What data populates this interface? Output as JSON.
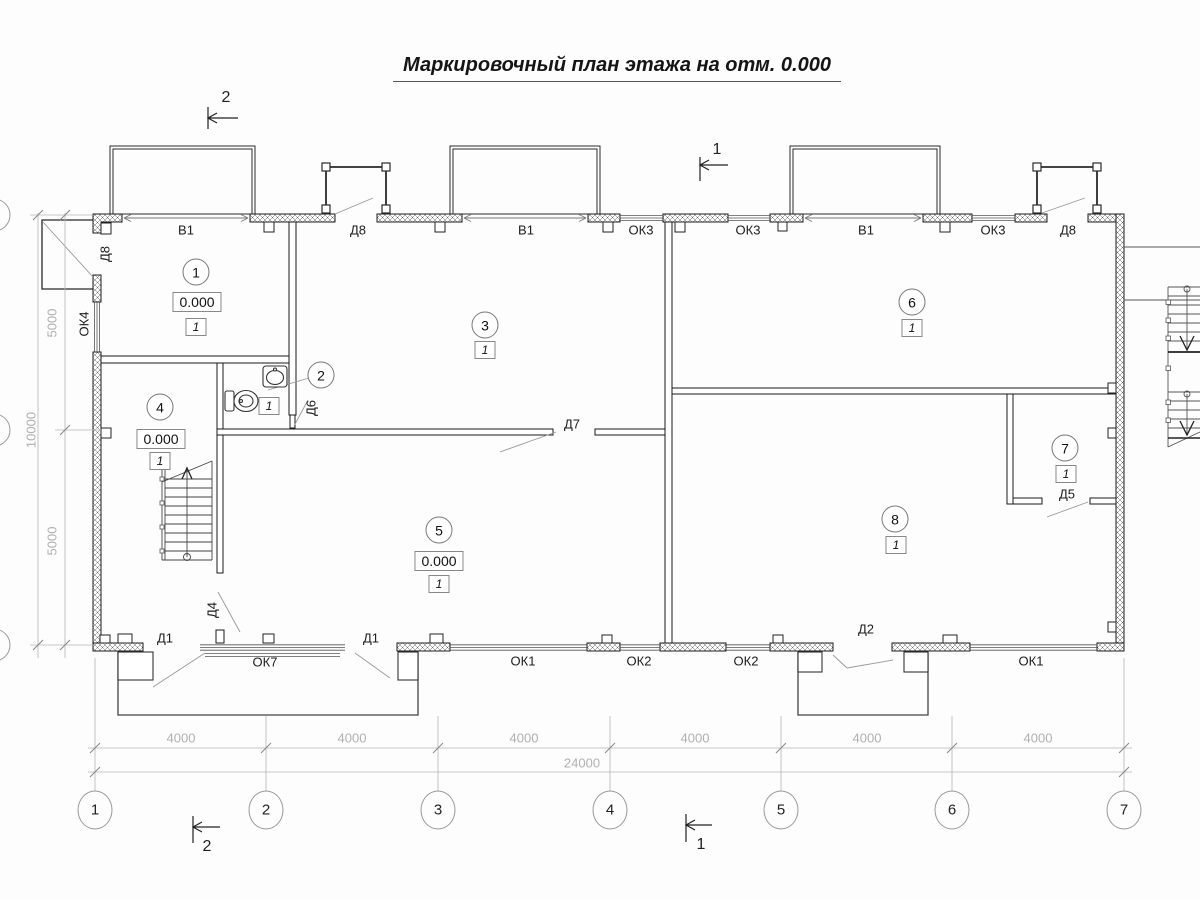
{
  "title": "Маркировочный план этажа на отм. 0.000",
  "rooms": [
    {
      "number": "1",
      "cx": 196,
      "cy": 272,
      "elevation": "0.000",
      "ex": 197,
      "ey": 302,
      "type": "1",
      "tx": 196,
      "ty": 327
    },
    {
      "number": "2",
      "cx": 321,
      "cy": 375,
      "type": "1",
      "tx": 269,
      "ty": 406
    },
    {
      "number": "3",
      "cx": 485,
      "cy": 325,
      "type": "1",
      "tx": 485,
      "ty": 350
    },
    {
      "number": "4",
      "cx": 160,
      "cy": 407,
      "elevation": "0.000",
      "ex": 161,
      "ey": 439,
      "type": "1",
      "tx": 160,
      "ty": 461
    },
    {
      "number": "5",
      "cx": 439,
      "cy": 530,
      "elevation": "0.000",
      "ex": 439,
      "ey": 561,
      "type": "1",
      "tx": 439,
      "ty": 584
    },
    {
      "number": "6",
      "cx": 912,
      "cy": 302,
      "type": "1",
      "tx": 912,
      "ty": 328
    },
    {
      "number": "7",
      "cx": 1065,
      "cy": 448,
      "type": "1",
      "tx": 1066,
      "ty": 474
    },
    {
      "number": "8",
      "cx": 895,
      "cy": 519,
      "type": "1",
      "tx": 896,
      "ty": 545
    }
  ],
  "opening_labels": [
    {
      "text": "В1",
      "x": 186,
      "y": 230
    },
    {
      "text": "Д8",
      "x": 358,
      "y": 230
    },
    {
      "text": "В1",
      "x": 526,
      "y": 230
    },
    {
      "text": "ОК3",
      "x": 641,
      "y": 230
    },
    {
      "text": "ОК3",
      "x": 748,
      "y": 230
    },
    {
      "text": "В1",
      "x": 866,
      "y": 230
    },
    {
      "text": "ОК3",
      "x": 993,
      "y": 230
    },
    {
      "text": "Д8",
      "x": 1068,
      "y": 230
    },
    {
      "text": "Д7",
      "x": 572,
      "y": 424
    },
    {
      "text": "Д5",
      "x": 1067,
      "y": 494
    },
    {
      "text": "Д1",
      "x": 165,
      "y": 638
    },
    {
      "text": "ОК7",
      "x": 265,
      "y": 662
    },
    {
      "text": "Д1",
      "x": 371,
      "y": 638
    },
    {
      "text": "ОК1",
      "x": 523,
      "y": 661
    },
    {
      "text": "ОК2",
      "x": 639,
      "y": 661
    },
    {
      "text": "ОК2",
      "x": 746,
      "y": 661
    },
    {
      "text": "Д2",
      "x": 866,
      "y": 629
    },
    {
      "text": "ОК1",
      "x": 1031,
      "y": 661
    },
    {
      "text": "Д8",
      "x": 105,
      "y": 254,
      "rot": true
    },
    {
      "text": "ОК4",
      "x": 84,
      "y": 324,
      "rot": true
    },
    {
      "text": "Д6",
      "x": 311,
      "y": 408,
      "rot": true
    },
    {
      "text": "Д4",
      "x": 212,
      "y": 610,
      "rot": true
    }
  ],
  "dimensions": {
    "bottom_segments": [
      {
        "text": "4000",
        "x": 181
      },
      {
        "text": "4000",
        "x": 352
      },
      {
        "text": "4000",
        "x": 524
      },
      {
        "text": "4000",
        "x": 695
      },
      {
        "text": "4000",
        "x": 867
      },
      {
        "text": "4000",
        "x": 1038
      }
    ],
    "segments_y": 738,
    "total": {
      "text": "24000",
      "x": 582,
      "y": 763
    },
    "left": [
      {
        "text": "5000",
        "x": 52,
        "y": 323
      },
      {
        "text": "10000",
        "x": 31,
        "y": 430
      },
      {
        "text": "5000",
        "x": 52,
        "y": 541
      }
    ]
  },
  "axes": {
    "y": 810,
    "items": [
      {
        "label": "1",
        "x": 95
      },
      {
        "label": "2",
        "x": 266
      },
      {
        "label": "3",
        "x": 438
      },
      {
        "label": "4",
        "x": 610
      },
      {
        "label": "5",
        "x": 781
      },
      {
        "label": "6",
        "x": 952
      },
      {
        "label": "7",
        "x": 1124
      }
    ]
  },
  "sections": [
    {
      "label": "2",
      "x": 226,
      "y": 98
    },
    {
      "label": "1",
      "x": 717,
      "y": 150
    },
    {
      "label": "2",
      "x": 207,
      "y": 847
    },
    {
      "label": "1",
      "x": 701,
      "y": 845
    }
  ]
}
